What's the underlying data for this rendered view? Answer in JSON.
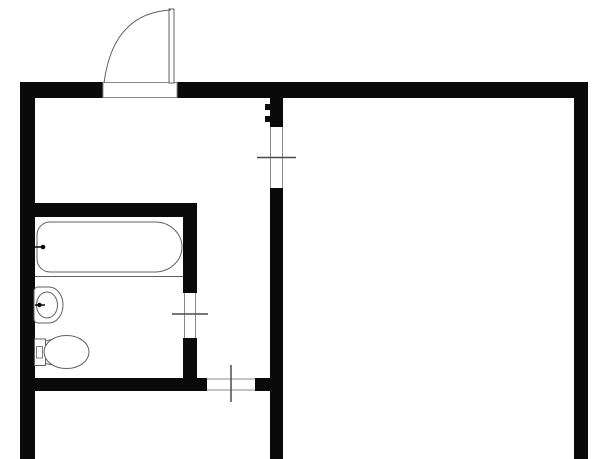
{
  "title": "apartment-floor-plan",
  "canvas": {
    "width": 613,
    "height": 459,
    "background_color": "#ffffff"
  },
  "palette": {
    "wall": "#0a0a0a",
    "thin": "#8a8a8a",
    "fixture": "#606060",
    "tick": "#4a4a4a",
    "white": "#ffffff",
    "none": "none"
  },
  "shapes": [
    {
      "name": "top-wall-left-segment",
      "type": "rect",
      "attrs": {
        "x": 20,
        "y": 82,
        "width": 83,
        "height": 16,
        "fill": "wall"
      }
    },
    {
      "name": "top-wall-right-segment",
      "type": "rect",
      "attrs": {
        "x": 177,
        "y": 82,
        "width": 411,
        "height": 16,
        "fill": "wall"
      }
    },
    {
      "name": "left-exterior-wall",
      "type": "rect",
      "attrs": {
        "x": 20,
        "y": 82,
        "width": 15,
        "height": 377,
        "fill": "wall"
      }
    },
    {
      "name": "right-exterior-wall",
      "type": "rect",
      "attrs": {
        "x": 574,
        "y": 82,
        "width": 14,
        "height": 377,
        "fill": "wall"
      }
    },
    {
      "name": "center-partition-upper",
      "type": "rect",
      "attrs": {
        "x": 270,
        "y": 98,
        "width": 13,
        "height": 29,
        "fill": "wall"
      }
    },
    {
      "name": "center-partition-hinge-notch-a",
      "type": "rect",
      "attrs": {
        "x": 265,
        "y": 104,
        "width": 5,
        "height": 6,
        "fill": "wall"
      }
    },
    {
      "name": "center-partition-hinge-notch-b",
      "type": "rect",
      "attrs": {
        "x": 265,
        "y": 116,
        "width": 5,
        "height": 6,
        "fill": "wall"
      }
    },
    {
      "name": "center-partition-lower",
      "type": "rect",
      "attrs": {
        "x": 270,
        "y": 188,
        "width": 13,
        "height": 271,
        "fill": "wall"
      }
    },
    {
      "name": "bathroom-top-wall",
      "type": "rect",
      "attrs": {
        "x": 35,
        "y": 203,
        "width": 162,
        "height": 14,
        "fill": "wall"
      }
    },
    {
      "name": "bathroom-right-wall-upper",
      "type": "rect",
      "attrs": {
        "x": 183,
        "y": 203,
        "width": 14,
        "height": 90,
        "fill": "wall"
      }
    },
    {
      "name": "bathroom-right-wall-lower",
      "type": "rect",
      "attrs": {
        "x": 183,
        "y": 338,
        "width": 14,
        "height": 53,
        "fill": "wall"
      }
    },
    {
      "name": "bathroom-bottom-wall",
      "type": "rect",
      "attrs": {
        "x": 20,
        "y": 378,
        "width": 187,
        "height": 13,
        "fill": "wall"
      }
    },
    {
      "name": "bottom-wall-stub",
      "type": "rect",
      "attrs": {
        "x": 255,
        "y": 378,
        "width": 15,
        "height": 13,
        "fill": "wall"
      }
    },
    {
      "name": "entry-door-opening",
      "type": "rect",
      "attrs": {
        "x": 103,
        "y": 82.5,
        "width": 74,
        "height": 15,
        "fill": "white",
        "stroke": "thin",
        "stroke-width": 1
      }
    },
    {
      "name": "entry-door-leaf",
      "type": "rect",
      "attrs": {
        "x": 169,
        "y": 9,
        "width": 5,
        "height": 74,
        "fill": "white",
        "stroke": "fixture",
        "stroke-width": 1
      }
    },
    {
      "name": "entry-door-swing-arc",
      "type": "path",
      "attrs": {
        "d": "M 171 10 Q 113 13 104 83",
        "fill": "none",
        "stroke": "fixture",
        "stroke-width": 1
      }
    },
    {
      "name": "center-opening-jamb-left",
      "type": "line",
      "attrs": {
        "x1": 270.5,
        "y1": 127,
        "x2": 270.5,
        "y2": 188,
        "stroke": "thin",
        "stroke-width": 1
      }
    },
    {
      "name": "center-opening-jamb-right",
      "type": "line",
      "attrs": {
        "x1": 282.5,
        "y1": 127,
        "x2": 282.5,
        "y2": 188,
        "stroke": "thin",
        "stroke-width": 1
      }
    },
    {
      "name": "center-opening-tick",
      "type": "line",
      "attrs": {
        "x1": 257,
        "y1": 157.5,
        "x2": 296,
        "y2": 157.5,
        "stroke": "tick",
        "stroke-width": 1.5
      }
    },
    {
      "name": "bathroom-door-jamb-left",
      "type": "line",
      "attrs": {
        "x1": 184.5,
        "y1": 293,
        "x2": 184.5,
        "y2": 338,
        "stroke": "thin",
        "stroke-width": 1
      }
    },
    {
      "name": "bathroom-door-jamb-right",
      "type": "line",
      "attrs": {
        "x1": 195.5,
        "y1": 293,
        "x2": 195.5,
        "y2": 338,
        "stroke": "thin",
        "stroke-width": 1
      }
    },
    {
      "name": "bathroom-door-tick",
      "type": "line",
      "attrs": {
        "x1": 172,
        "y1": 314,
        "x2": 208,
        "y2": 314,
        "stroke": "tick",
        "stroke-width": 1.5
      }
    },
    {
      "name": "bottom-opening-edge-top",
      "type": "line",
      "attrs": {
        "x1": 207,
        "y1": 379,
        "x2": 255,
        "y2": 379,
        "stroke": "thin",
        "stroke-width": 1
      }
    },
    {
      "name": "bottom-opening-edge-bottom",
      "type": "line",
      "attrs": {
        "x1": 207,
        "y1": 390,
        "x2": 255,
        "y2": 390,
        "stroke": "thin",
        "stroke-width": 1
      }
    },
    {
      "name": "bottom-opening-tick",
      "type": "line",
      "attrs": {
        "x1": 231,
        "y1": 365,
        "x2": 231,
        "y2": 402,
        "stroke": "tick",
        "stroke-width": 1.5
      }
    },
    {
      "name": "bathtub-body",
      "type": "path",
      "attrs": {
        "d": "M 50 222 L 155 222 A 27 25 0 0 1 155 272 L 50 272 A 13 13 0 0 1 37 259 L 37 235 A 13 13 0 0 1 50 222 Z",
        "fill": "white",
        "stroke": "fixture",
        "stroke-width": 1
      }
    },
    {
      "name": "bathtub-rim-line",
      "type": "line",
      "attrs": {
        "x1": 35,
        "y1": 276.5,
        "x2": 183,
        "y2": 276.5,
        "stroke": "fixture",
        "stroke-width": 1
      }
    },
    {
      "name": "bathtub-tap-line",
      "type": "line",
      "attrs": {
        "x1": 33,
        "y1": 247,
        "x2": 43,
        "y2": 247,
        "stroke": "wall",
        "stroke-width": 1.5
      }
    },
    {
      "name": "bathtub-tap-dot",
      "type": "circle",
      "attrs": {
        "cx": 43,
        "cy": 247,
        "r": 2.3,
        "fill": "wall"
      }
    },
    {
      "name": "sink-body",
      "type": "path",
      "attrs": {
        "d": "M 38 287 L 49 287 A 14 18 0 0 1 63 305 A 14 18 0 0 1 49 323 L 38 323 A 4 4 0 0 1 34 319 L 34 291 A 4 4 0 0 1 38 287 Z",
        "fill": "white",
        "stroke": "fixture",
        "stroke-width": 1
      }
    },
    {
      "name": "sink-basin",
      "type": "ellipse",
      "attrs": {
        "cx": 47,
        "cy": 305,
        "rx": 10.5,
        "ry": 13,
        "fill": "none",
        "stroke": "fixture",
        "stroke-width": 1
      }
    },
    {
      "name": "sink-tap-line",
      "type": "line",
      "attrs": {
        "x1": 35,
        "y1": 305,
        "x2": 45,
        "y2": 305,
        "stroke": "wall",
        "stroke-width": 1.5
      }
    },
    {
      "name": "sink-tap-dot",
      "type": "circle",
      "attrs": {
        "cx": 39.5,
        "cy": 305,
        "r": 2.2,
        "fill": "wall"
      }
    },
    {
      "name": "toilet-tank",
      "type": "rect",
      "attrs": {
        "x": 34.5,
        "y": 339,
        "width": 11,
        "height": 26.5,
        "fill": "white",
        "stroke": "fixture",
        "stroke-width": 1
      }
    },
    {
      "name": "toilet-tank-detail",
      "type": "rect",
      "attrs": {
        "x": 36.5,
        "y": 346.5,
        "width": 6,
        "height": 11.5,
        "fill": "none",
        "stroke": "fixture",
        "stroke-width": 0.8
      }
    },
    {
      "name": "toilet-connector",
      "type": "path",
      "attrs": {
        "d": "M 45.5 341 L 60 337.5 L 60 366.5 L 45.5 363.5 Z",
        "fill": "white",
        "stroke": "fixture",
        "stroke-width": 1
      }
    },
    {
      "name": "toilet-bowl",
      "type": "ellipse",
      "attrs": {
        "cx": 66.5,
        "cy": 352,
        "rx": 22.5,
        "ry": 16.5,
        "fill": "white",
        "stroke": "fixture",
        "stroke-width": 1
      }
    }
  ]
}
